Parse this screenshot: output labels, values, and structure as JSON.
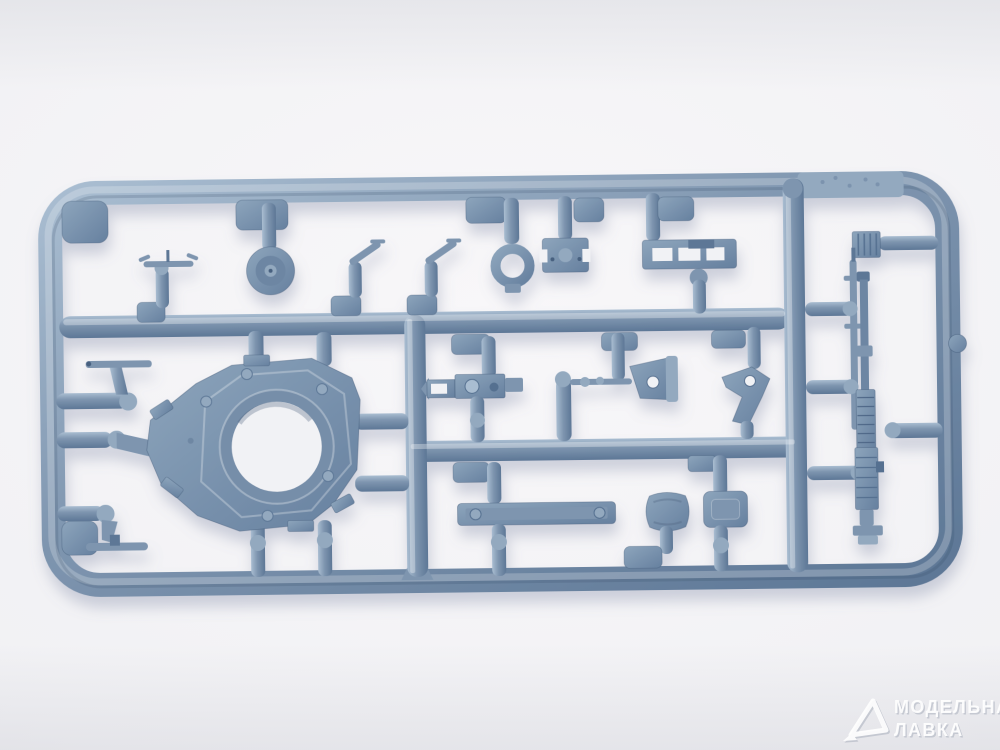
{
  "image": {
    "alt": "Photo of a blue-gray injection-molded plastic model kit sprue (parts frame) on a white studio background"
  },
  "watermark": {
    "logo_icon": "model-shop-triangle-logo",
    "line1": "МОДЕЛЬНАЯ",
    "line2": "ЛАВКА"
  },
  "palette": {
    "plastic_light": "#a9bdd1",
    "plastic_mid": "#7e95af",
    "plastic_dark": "#5d7796",
    "plastic_deep": "#46607f",
    "plate_light": "#8da5bc",
    "plate_dark": "#66809f",
    "background_center": "#f8f7f9",
    "background_edge": "#e2e2e7",
    "hole_background": "#f1f2f5",
    "cast_shadow": "#767f9e",
    "watermark_color": "#ffffff"
  },
  "parts_inventory": [
    "rounded rectangular sprue frame",
    "turret ring plate with large circular opening",
    "road-wheel disc",
    "hatch ring",
    "gun mount bracket",
    "slotted rail",
    "antenna mount",
    "two periscope posts",
    "thin rod",
    "vision port plug",
    "hinge bar",
    "machine-gun receiver",
    "linkage arm with cone bracket",
    "tow hook",
    "fender strip",
    "cushion pad",
    "hatch panel",
    "heavy machine gun",
    "spare barrel",
    "ribbed block"
  ]
}
